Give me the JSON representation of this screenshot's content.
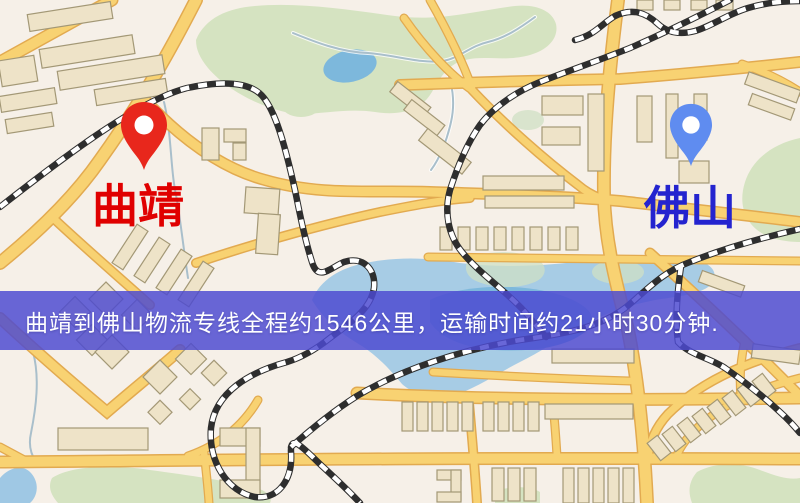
{
  "page": {
    "width": 800,
    "height": 503,
    "kind": "logistics-route-map"
  },
  "map": {
    "origin": {
      "name": "曲靖",
      "pin_icon": "location-pin-icon",
      "pin_color": "#e8271c",
      "label_color": "#e00000"
    },
    "destination": {
      "name": "佛山",
      "pin_icon": "location-pin-icon",
      "pin_color": "#5f8cf0",
      "label_color": "#2424cf"
    },
    "banner": {
      "text": "曲靖到佛山物流专线全程约1546公里，运输时间约21小时30分钟.",
      "distance_km": "1546",
      "duration": "21小时30分钟",
      "bg_color": "#4c4ad0",
      "text_color": "#ffffff"
    },
    "colors": {
      "land": "#f6f0e8",
      "park": "#d5e3c1",
      "park_wet": "#cfe0c4",
      "water": "#9fc8e4",
      "water_deep": "#7db8dc",
      "stream": "#a9bfcb",
      "road": "#f8d272",
      "road_casing": "#e2aa50",
      "building": "#eee3c8",
      "building_stroke": "#a39876",
      "railway_dark": "#2e2e2e",
      "railway_light": "#ffffff"
    }
  }
}
